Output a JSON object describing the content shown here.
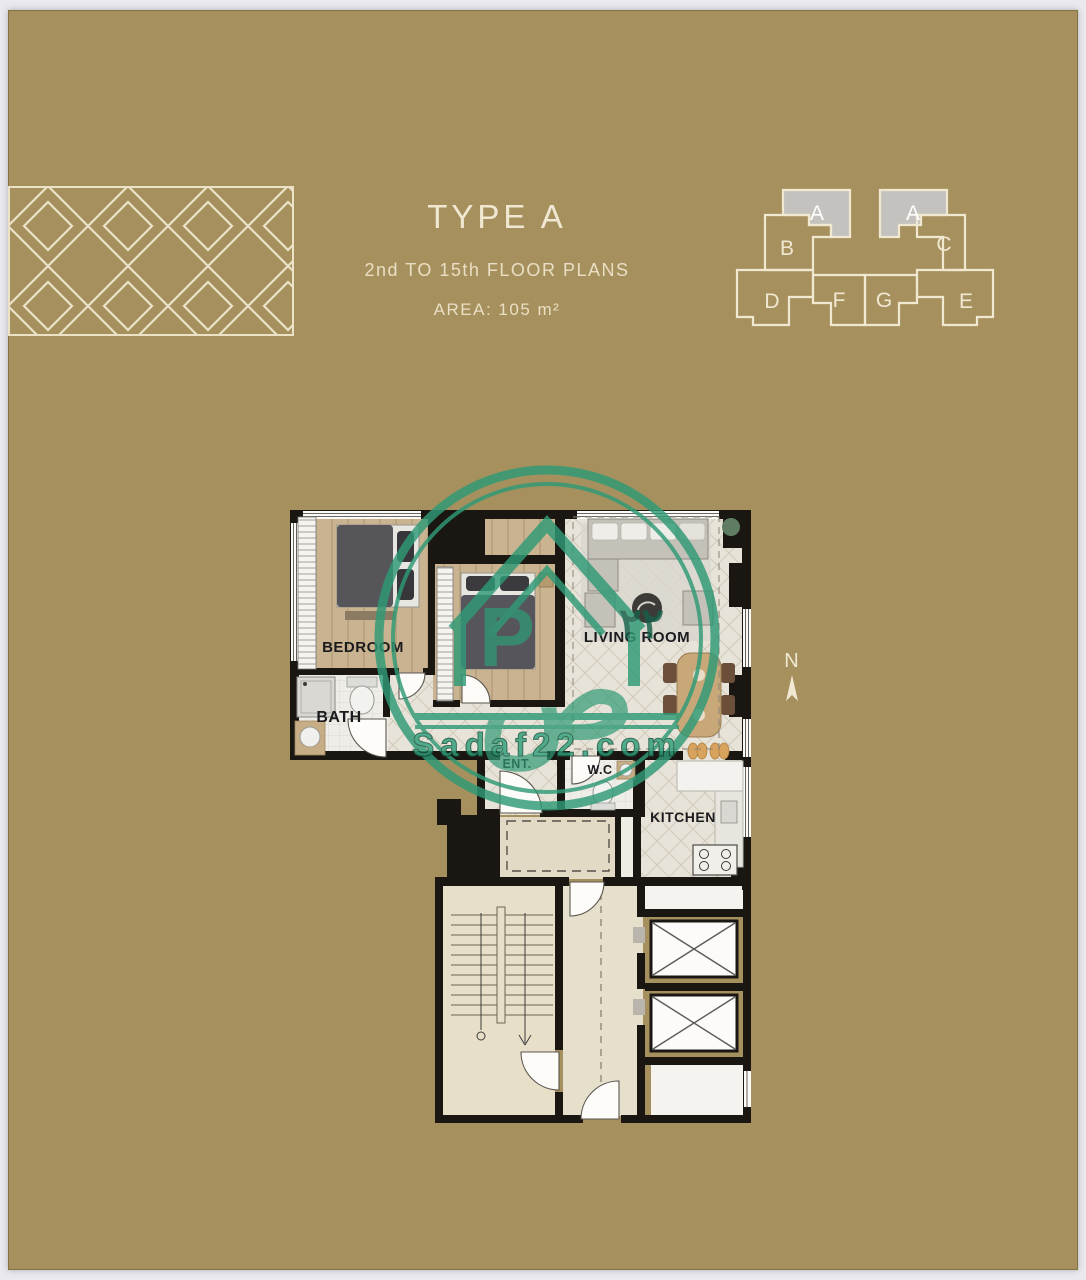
{
  "header": {
    "title": "TYPE A",
    "subtitle": "2nd TO 15th FLOOR PLANS",
    "area": "AREA: 105 m²"
  },
  "key_plan": {
    "units": [
      "A",
      "A",
      "B",
      "C",
      "D",
      "E",
      "F",
      "G"
    ],
    "highlighted_unit": "A"
  },
  "floor_plan": {
    "rooms": [
      "BEDROOM",
      "BATH",
      "LIVING ROOM",
      "ENT.",
      "W.C",
      "KITCHEN"
    ]
  },
  "compass": {
    "label": "N"
  },
  "watermark": {
    "site": "Sadaf22.com",
    "monogram": "P",
    "arabic_letter": "ص",
    "arabic_numerals": "٢٢"
  },
  "colors": {
    "background": "#a6915e",
    "cream": "#efe6cf",
    "pattern_line": "#ece2c8",
    "wall_black": "#1a1713",
    "watermark_green": "#2f9a76",
    "unit_highlight_gray": "#c7c7c7"
  }
}
